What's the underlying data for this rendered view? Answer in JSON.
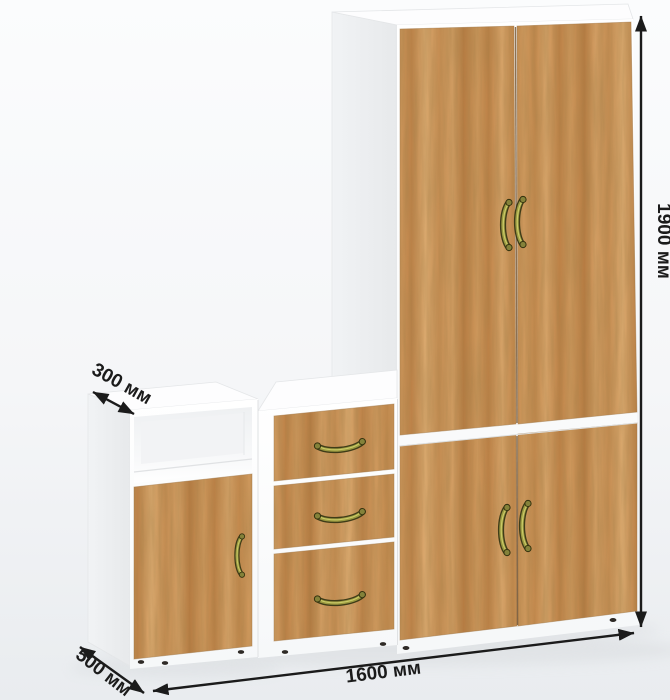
{
  "dimensions": {
    "height": "1900 мм",
    "width": "1600 мм",
    "depth": "500 мм",
    "upper_depth": "300 мм"
  },
  "palette": {
    "background": "#f5f6f8",
    "floor_shade": "#e9ecef",
    "carcass_white": "#ffffff",
    "carcass_shadow": "#eceef0",
    "wood_base": "#c98f55",
    "wood_light": "#e0ad72",
    "wood_dark": "#b97c42",
    "handle_brass": "#9b9a41",
    "handle_brass_dark": "#3f3c18",
    "dimension_ink": "#1b1b1b"
  },
  "icons": {
    "height_arrow": "double-headed-arrow-vertical",
    "width_arrow": "double-headed-arrow-horizontal",
    "depth_arrow": "double-headed-arrow-diagonal",
    "upper_depth_arrow": "double-headed-arrow-diagonal"
  }
}
